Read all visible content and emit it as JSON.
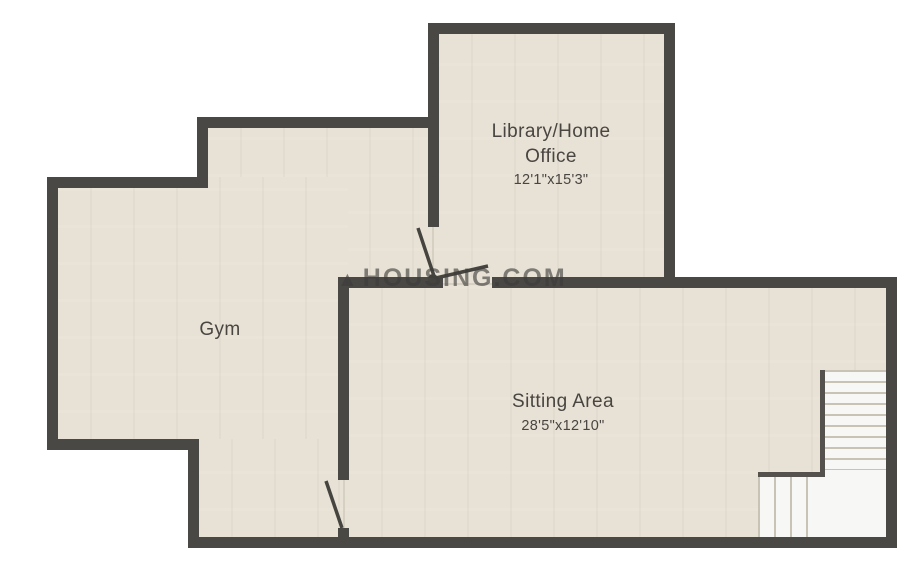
{
  "watermark": {
    "logo_glyph": "▲",
    "text": "HOUSING.COM"
  },
  "rooms": {
    "library": {
      "name": "Library/Home Office",
      "dimensions": "12'1\"x15'3\""
    },
    "gym": {
      "name": "Gym"
    },
    "sitting": {
      "name": "Sitting Area",
      "dimensions": "28'5\"x12'10\""
    }
  },
  "colors": {
    "wall": "#4a4845",
    "floor": "#e8e2d6",
    "stairs_fill": "#f7f7f5",
    "stairs_line": "#c9c3b6",
    "background": "#ffffff",
    "text": "#494541",
    "watermark": "rgba(62,60,58,0.62)"
  }
}
